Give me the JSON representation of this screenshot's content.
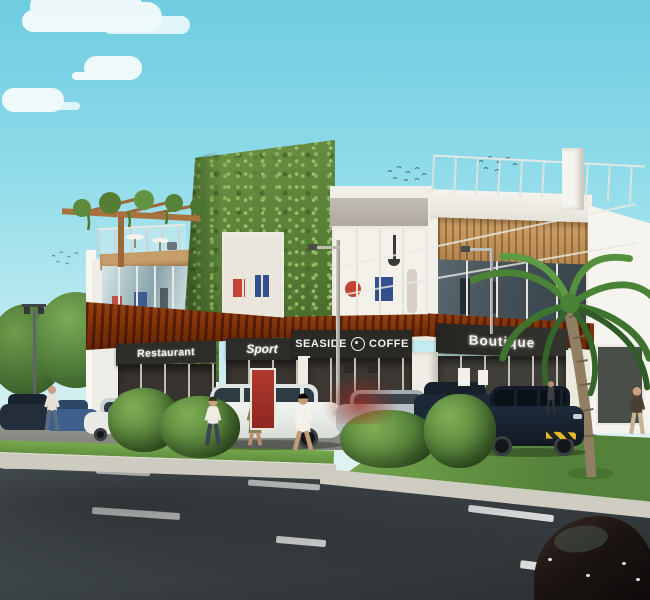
{
  "scene": {
    "type": "architectural-rendering",
    "title": "Two-story seaside retail center rendering",
    "signs": {
      "restaurant": "Restaurant",
      "sport": "Sport",
      "seaside_left": "SEASIDE",
      "seaside_right": "COFFE",
      "boutique": "Boutique"
    },
    "palette": {
      "sky_top": "#6fcce1",
      "sky_bottom": "#e9f5ee",
      "ivy_green": "#5d8a3c",
      "awning_wood": "#bf7a33",
      "wood_band": "#c79a63",
      "sign_background": "#2d2b27",
      "sign_text": "#f4f3ee",
      "facade_white": "#f2f0ea",
      "concrete": "#b7b2a8",
      "storefront_glass": "#3a3531",
      "accent_red_door": "#a03028",
      "road_asphalt": "#3a4246",
      "grass": "#67963f",
      "sidewalk": "#cdcabf"
    },
    "objects": {
      "building": "two-story retail center with ivy living-wall tower, rooftop terrace, pergola and wood-slat awnings",
      "vehicles": "row of parked cars and SUVs along the storefronts; dark car at bottom-right on the road",
      "pedestrians": "six people walking near the storefronts and sidewalk",
      "vegetation": "ivy wall, round bushes, street trees at left, palm tree at right",
      "road": "multi-lane asphalt road with dashed white lane markings"
    }
  }
}
